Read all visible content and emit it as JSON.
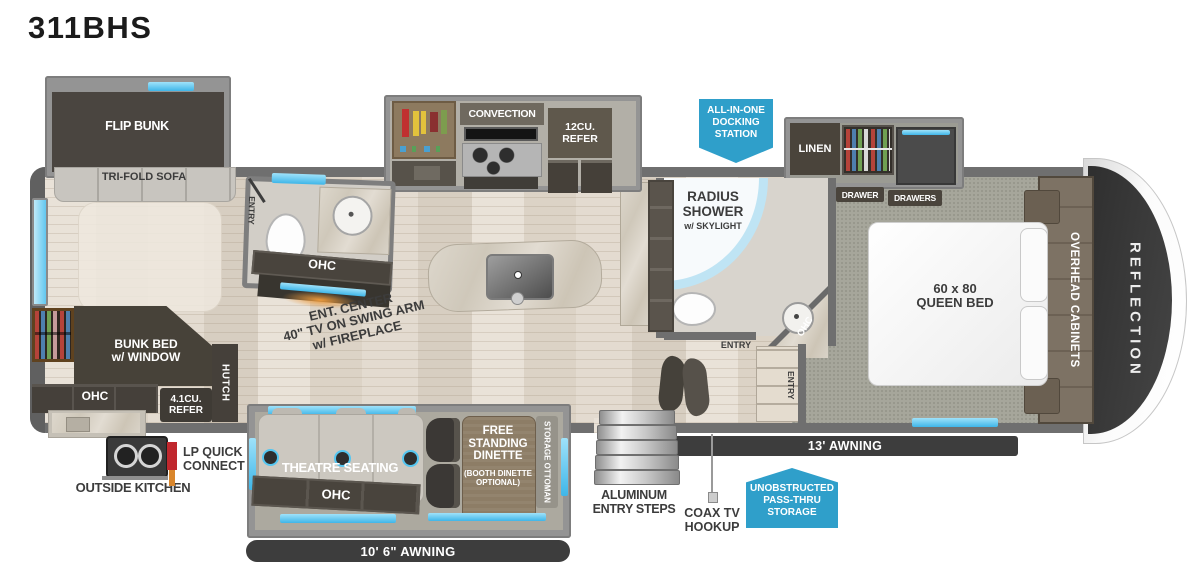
{
  "title": "311BHS",
  "colors": {
    "badge_blue": "#2f9fca",
    "accent_blue": "#55c6f0",
    "awning_bar": "#3d3d3d",
    "label_dark": "#3c3c3c",
    "lp_red": "#c0272d",
    "lp_orange": "#d9862c"
  },
  "labels": {
    "ohc": "OHC",
    "entry": "ENTRY"
  },
  "exterior": {
    "brand": "REFLECTION",
    "front_awning": "13' AWNING",
    "rear_awning": "10' 6\" AWNING",
    "entry_steps": "ALUMINUM\nENTRY STEPS",
    "coax": "COAX TV\nHOOKUP",
    "outside_kitchen": "OUTSIDE KITCHEN",
    "lp_connect": "LP QUICK\nCONNECT",
    "docking_badge": "ALL-IN-ONE\nDOCKING\nSTATION",
    "passthru_badge": "UNOBSTRUCTED\nPASS-THRU\nSTORAGE"
  },
  "bunk_room": {
    "flip_bunk": "FLIP BUNK",
    "sofa": "TRI-FOLD SOFA",
    "bunk_bed": "BUNK BED\nw/ WINDOW",
    "refer": "4.1CU.\nREFER",
    "hutch": "HUTCH"
  },
  "living": {
    "ent_center": "ENT. CENTER\n40\" TV ON SWING ARM\nw/ FIREPLACE"
  },
  "kitchen": {
    "convection": "CONVECTION",
    "refer": "12CU.\nREFER"
  },
  "bath": {
    "shower_name": "RADIUS\nSHOWER",
    "shower_sub": "w/ SKYLIGHT"
  },
  "bedroom": {
    "bed": "60 x 80\nQUEEN BED",
    "linen": "LINEN",
    "drawers": [
      "DRAWER",
      "DRAWER",
      "DRAWERS"
    ],
    "overhead": "OVERHEAD CABINETS"
  },
  "garage_slide": {
    "theatre": "THEATRE SEATING",
    "dinette": "FREE\nSTANDING\nDINETTE",
    "dinette_note": "(BOOTH DINETTE\nOPTIONAL)",
    "ottoman": "STORAGE OTTOMAN"
  }
}
